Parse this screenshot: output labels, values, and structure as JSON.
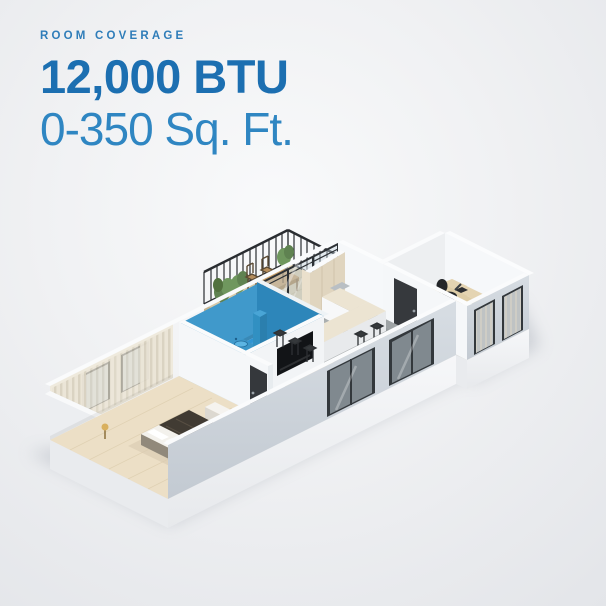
{
  "heading": {
    "eyebrow": "ROOM COVERAGE",
    "btu": "12,000 BTU",
    "coverage": "0-350 Sq. Ft."
  },
  "palette": {
    "eyebrow_color": "#2f7db9",
    "btu_color": "#1c6fb1",
    "coverage_color": "#2f86c2",
    "highlight_room_color": "#3195d3",
    "background_tint": "#f0f1f3"
  },
  "floor_plan": {
    "highlighted_room": "bathroom",
    "rooms": [
      "bedroom",
      "bathroom",
      "living-room",
      "kitchen",
      "home-office",
      "balcony"
    ]
  }
}
